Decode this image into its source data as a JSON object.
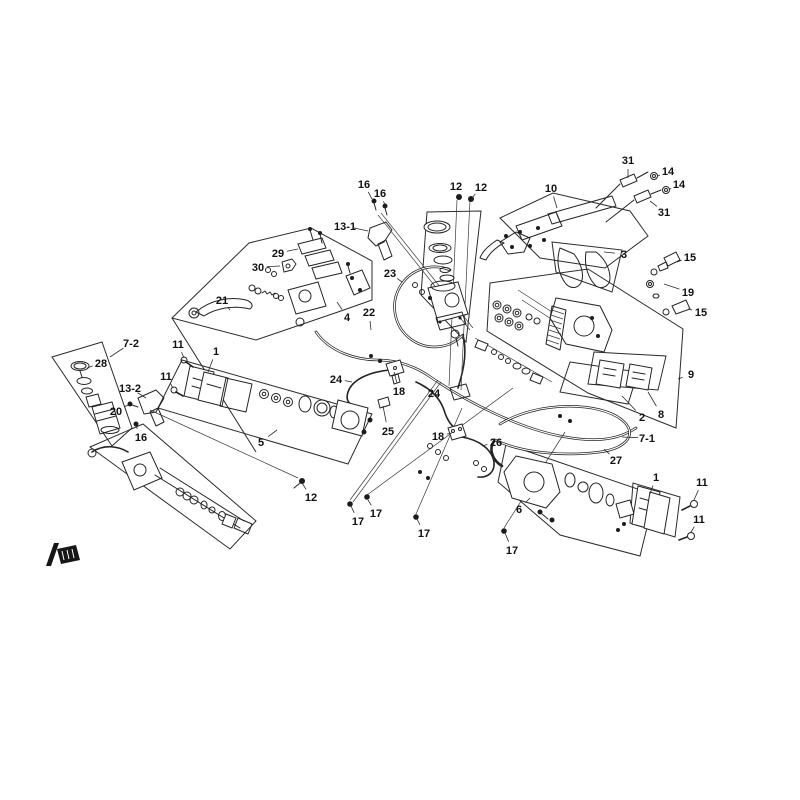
{
  "diagram": {
    "type": "exploded-parts-diagram",
    "subject": "brake-system",
    "background": "#ffffff",
    "line_color": "#242424",
    "label_color": "#111111",
    "brand_mark": "logo-mark",
    "callouts": [
      {
        "label": "16",
        "x": 364,
        "y": 184,
        "tx": 372,
        "ty": 199
      },
      {
        "label": "16",
        "x": 380,
        "y": 193,
        "tx": 385,
        "ty": 205
      },
      {
        "label": "13-1",
        "x": 345,
        "y": 226,
        "tx": 368,
        "ty": 231
      },
      {
        "label": "12",
        "x": 456,
        "y": 186,
        "tx": 459,
        "ty": 196
      },
      {
        "label": "12",
        "x": 481,
        "y": 187,
        "tx": 472,
        "ty": 198
      },
      {
        "label": "10",
        "x": 551,
        "y": 188,
        "tx": 557,
        "ty": 208
      },
      {
        "label": "31",
        "x": 628,
        "y": 160,
        "tx": 628,
        "ty": 178
      },
      {
        "label": "14",
        "x": 668,
        "y": 171,
        "tx": 658,
        "ty": 176
      },
      {
        "label": "14",
        "x": 679,
        "y": 184,
        "tx": 670,
        "ty": 189
      },
      {
        "label": "31",
        "x": 664,
        "y": 212,
        "tx": 650,
        "ty": 201
      },
      {
        "label": "3",
        "x": 624,
        "y": 254,
        "tx": 604,
        "ty": 252
      },
      {
        "label": "15",
        "x": 690,
        "y": 257,
        "tx": 677,
        "ty": 262
      },
      {
        "label": "19",
        "x": 688,
        "y": 292,
        "tx": 664,
        "ty": 284
      },
      {
        "label": "15",
        "x": 701,
        "y": 312,
        "tx": 688,
        "ty": 309
      },
      {
        "label": "29",
        "x": 278,
        "y": 253,
        "tx": 298,
        "ty": 249
      },
      {
        "label": "30",
        "x": 258,
        "y": 267,
        "tx": 280,
        "ty": 266
      },
      {
        "label": "21",
        "x": 222,
        "y": 300,
        "tx": 230,
        "ty": 310
      },
      {
        "label": "4",
        "x": 347,
        "y": 317,
        "tx": 337,
        "ty": 302
      },
      {
        "label": "22",
        "x": 369,
        "y": 312,
        "tx": 371,
        "ty": 330
      },
      {
        "label": "23",
        "x": 390,
        "y": 273,
        "tx": 402,
        "ty": 282
      },
      {
        "label": "9",
        "x": 691,
        "y": 374,
        "tx": 678,
        "ty": 379
      },
      {
        "label": "8",
        "x": 661,
        "y": 414,
        "tx": 648,
        "ty": 392
      },
      {
        "label": "2",
        "x": 642,
        "y": 417,
        "tx": 622,
        "ty": 396
      },
      {
        "label": "7-1",
        "x": 647,
        "y": 438,
        "tx": 622,
        "ty": 437
      },
      {
        "label": "27",
        "x": 616,
        "y": 460,
        "tx": 604,
        "ty": 449
      },
      {
        "label": "7-2",
        "x": 131,
        "y": 343,
        "tx": 110,
        "ty": 357
      },
      {
        "label": "28",
        "x": 101,
        "y": 363,
        "tx": 87,
        "ty": 368
      },
      {
        "label": "11",
        "x": 178,
        "y": 344,
        "tx": 184,
        "ty": 358
      },
      {
        "label": "1",
        "x": 216,
        "y": 351,
        "tx": 208,
        "ty": 372
      },
      {
        "label": "11",
        "x": 166,
        "y": 376,
        "tx": 173,
        "ty": 388
      },
      {
        "label": "13-2",
        "x": 130,
        "y": 388,
        "tx": 146,
        "ty": 398
      },
      {
        "label": "20",
        "x": 116,
        "y": 411,
        "tx": 128,
        "ty": 405
      },
      {
        "label": "16",
        "x": 141,
        "y": 437,
        "tx": 136,
        "ty": 426
      },
      {
        "label": "5",
        "x": 261,
        "y": 442,
        "tx": 277,
        "ty": 430
      },
      {
        "label": "24",
        "x": 336,
        "y": 379,
        "tx": 352,
        "ty": 382
      },
      {
        "label": "18",
        "x": 399,
        "y": 391,
        "tx": 394,
        "ty": 372
      },
      {
        "label": "24",
        "x": 434,
        "y": 393,
        "tx": 421,
        "ty": 385
      },
      {
        "label": "25",
        "x": 388,
        "y": 431,
        "tx": 383,
        "ty": 406
      },
      {
        "label": "18",
        "x": 438,
        "y": 436,
        "tx": 452,
        "ty": 433
      },
      {
        "label": "26",
        "x": 496,
        "y": 442,
        "tx": 482,
        "ty": 446
      },
      {
        "label": "12",
        "x": 311,
        "y": 497,
        "tx": 302,
        "ty": 483
      },
      {
        "label": "17",
        "x": 358,
        "y": 521,
        "tx": 351,
        "ty": 506
      },
      {
        "label": "17",
        "x": 376,
        "y": 513,
        "tx": 368,
        "ty": 500
      },
      {
        "label": "17",
        "x": 424,
        "y": 533,
        "tx": 417,
        "ty": 519
      },
      {
        "label": "17",
        "x": 512,
        "y": 550,
        "tx": 505,
        "ty": 533
      },
      {
        "label": "6",
        "x": 519,
        "y": 509,
        "tx": 530,
        "ty": 498
      },
      {
        "label": "1",
        "x": 656,
        "y": 477,
        "tx": 650,
        "ty": 494
      },
      {
        "label": "11",
        "x": 702,
        "y": 482,
        "tx": 694,
        "ty": 500
      },
      {
        "label": "11",
        "x": 699,
        "y": 519,
        "tx": 691,
        "ty": 532
      }
    ]
  }
}
